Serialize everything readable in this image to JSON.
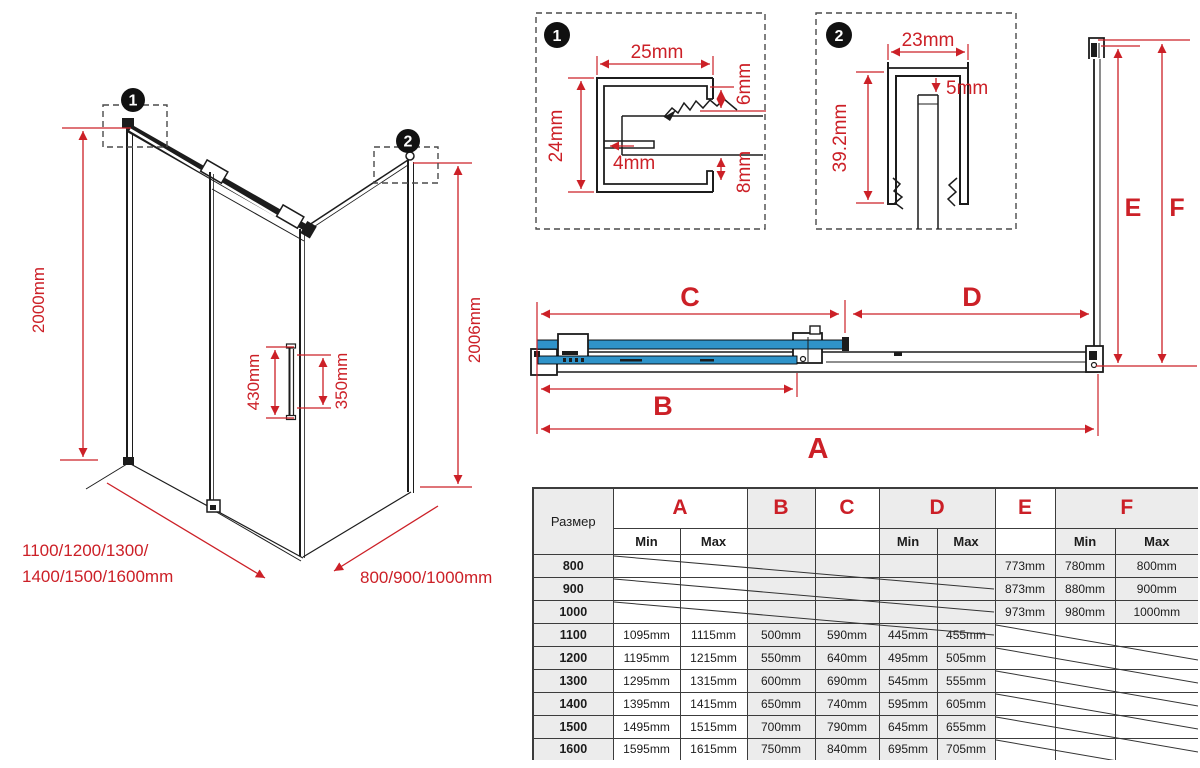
{
  "colors": {
    "dimension_red": "#cc2027",
    "glass_blue": "#2f93c9",
    "line_black": "#1c1c1c",
    "table_shade": "#ececec"
  },
  "iso": {
    "badge_1": "1",
    "badge_2": "2",
    "height_front": "2000mm",
    "height_side": "2006mm",
    "handle_length": "430mm",
    "handle_holes": "350mm",
    "width_options_line1": "1100/1200/1300/",
    "width_options_line2": "1400/1500/1600mm",
    "depth_options": "800/900/1000mm"
  },
  "detail_1": {
    "badge": "1",
    "width_top": "25mm",
    "height_left": "24mm",
    "gap_top": "6mm",
    "wall": "4mm",
    "gap_bottom": "8mm"
  },
  "detail_2": {
    "badge": "2",
    "width_top": "23mm",
    "gap": "5mm",
    "height": "39.2mm"
  },
  "plan": {
    "dim_a": "A",
    "dim_b": "B",
    "dim_c": "C",
    "dim_d": "D",
    "dim_e": "E",
    "dim_f": "F"
  },
  "table": {
    "size_header": "Размер",
    "min_label": "Min",
    "max_label": "Max",
    "col_letters": [
      "A",
      "B",
      "C",
      "D",
      "E",
      "F"
    ],
    "rows": [
      {
        "size": "800",
        "group": "small",
        "strike": "ad",
        "cells": [
          "",
          "",
          "",
          "",
          "",
          "",
          "773mm",
          "780mm",
          "800mm"
        ]
      },
      {
        "size": "900",
        "group": "small",
        "strike": "ad",
        "cells": [
          "",
          "",
          "",
          "",
          "",
          "",
          "873mm",
          "880mm",
          "900mm"
        ]
      },
      {
        "size": "1000",
        "group": "small",
        "strike": "ad",
        "cells": [
          "",
          "",
          "",
          "",
          "",
          "",
          "973mm",
          "980mm",
          "1000mm"
        ]
      },
      {
        "size": "1100",
        "group": "large",
        "strike": "ef",
        "cells": [
          "1095mm",
          "1115mm",
          "500mm",
          "590mm",
          "445mm",
          "455mm",
          "",
          "",
          ""
        ]
      },
      {
        "size": "1200",
        "group": "large",
        "strike": "ef",
        "cells": [
          "1195mm",
          "1215mm",
          "550mm",
          "640mm",
          "495mm",
          "505mm",
          "",
          "",
          ""
        ]
      },
      {
        "size": "1300",
        "group": "large",
        "strike": "ef",
        "cells": [
          "1295mm",
          "1315mm",
          "600mm",
          "690mm",
          "545mm",
          "555mm",
          "",
          "",
          ""
        ]
      },
      {
        "size": "1400",
        "group": "large",
        "strike": "ef",
        "cells": [
          "1395mm",
          "1415mm",
          "650mm",
          "740mm",
          "595mm",
          "605mm",
          "",
          "",
          ""
        ]
      },
      {
        "size": "1500",
        "group": "large",
        "strike": "ef",
        "cells": [
          "1495mm",
          "1515mm",
          "700mm",
          "790mm",
          "645mm",
          "655mm",
          "",
          "",
          ""
        ]
      },
      {
        "size": "1600",
        "group": "large",
        "strike": "ef",
        "cells": [
          "1595mm",
          "1615mm",
          "750mm",
          "840mm",
          "695mm",
          "705mm",
          "",
          "",
          ""
        ]
      }
    ]
  }
}
